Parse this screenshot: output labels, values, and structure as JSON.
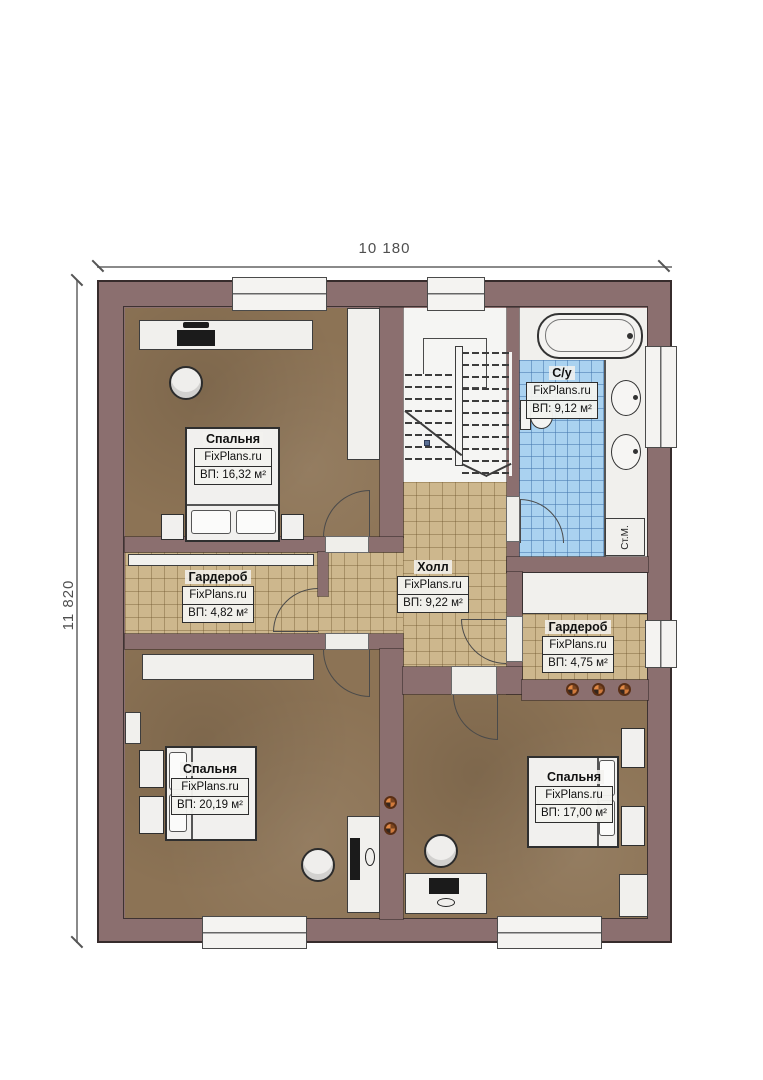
{
  "title": "Floor plan – second floor",
  "dims": {
    "width_label": "10 180",
    "height_label": "11 820"
  },
  "rooms": [
    {
      "id": "bedroom-top-left",
      "name": "Спальня",
      "brand": "FixPlans.ru",
      "area": "ВП: 16,32 м²"
    },
    {
      "id": "wardrobe-left",
      "name": "Гардероб",
      "brand": "FixPlans.ru",
      "area": "ВП: 4,82 м²"
    },
    {
      "id": "hall",
      "name": "Холл",
      "brand": "FixPlans.ru",
      "area": "ВП: 9,22 м²"
    },
    {
      "id": "bathroom",
      "name": "С/у",
      "brand": "FixPlans.ru",
      "area": "ВП: 9,12 м²"
    },
    {
      "id": "wardrobe-right",
      "name": "Гардероб",
      "brand": "FixPlans.ru",
      "area": "ВП: 4,75 м²"
    },
    {
      "id": "bedroom-bottom-left",
      "name": "Спальня",
      "brand": "FixPlans.ru",
      "area": "ВП: 20,19 м²"
    },
    {
      "id": "bedroom-bottom-right",
      "name": "Спальня",
      "brand": "FixPlans.ru",
      "area": "ВП: 17,00 м²"
    }
  ],
  "fixtures": {
    "washing_machine_label": "Ст.М."
  },
  "colors": {
    "wall": "#8b6f6f",
    "floor_bedroom": "#8c7355",
    "floor_tile": "#cdb78d",
    "floor_bath": "#aad2f0",
    "furniture": "#f1f0ed",
    "spotlight": "#d07a3c"
  }
}
